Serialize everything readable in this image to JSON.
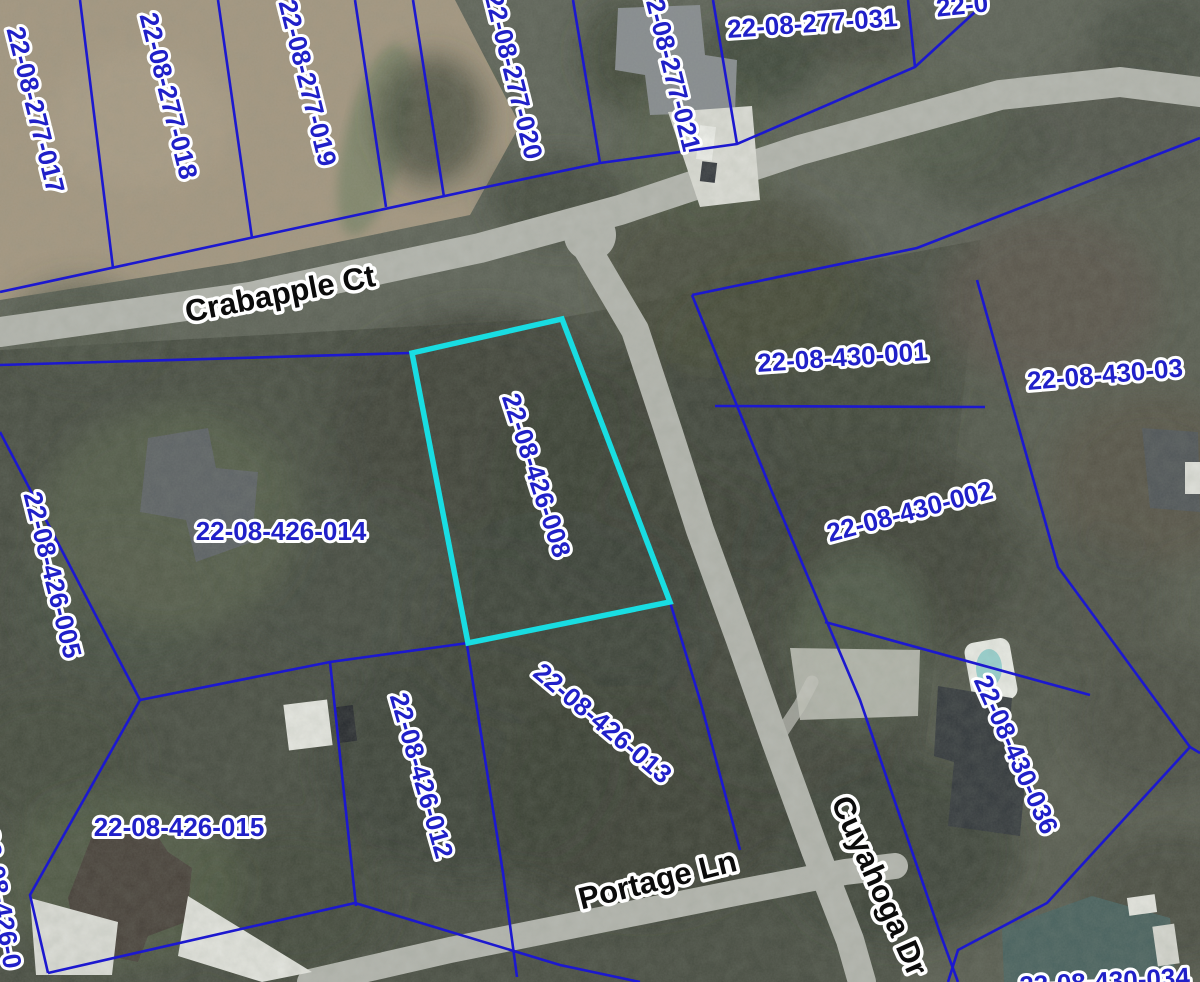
{
  "map": {
    "type": "gis-parcel-aerial-map",
    "highlighted_parcel": {
      "id": "22-08-426-008",
      "outline_color": "#19dde2"
    },
    "colors": {
      "parcel_line": "#1c18cf",
      "parcel_label_fill": "#2020c8",
      "label_halo": "#ffffff",
      "street_label_fill": "#0b0b0b",
      "road_surface": "#b6b8b1"
    },
    "street_labels": [
      {
        "text": "Crabapple Ct"
      },
      {
        "text": "Portage Ln"
      },
      {
        "text": "Cuyahoga Dr"
      }
    ],
    "parcel_labels": [
      {
        "text": "22-08-277-017"
      },
      {
        "text": "22-08-277-018"
      },
      {
        "text": "22-08-277-019"
      },
      {
        "text": "22-08-277-020"
      },
      {
        "text": "22-08-277-021"
      },
      {
        "text": "22-08-277-031"
      },
      {
        "text": "22-0"
      },
      {
        "text": "22-08-426-008"
      },
      {
        "text": "22-08-430-001"
      },
      {
        "text": "22-08-430-03"
      },
      {
        "text": "22-08-426-014"
      },
      {
        "text": "22-08-426-005"
      },
      {
        "text": "22-08-430-002"
      },
      {
        "text": "22-08-430-036"
      },
      {
        "text": "22-08-426-012"
      },
      {
        "text": "22-08-426-013"
      },
      {
        "text": "22-08-426-015"
      },
      {
        "text": "22-08-430-034"
      },
      {
        "text": "22-08-426-0"
      }
    ]
  }
}
